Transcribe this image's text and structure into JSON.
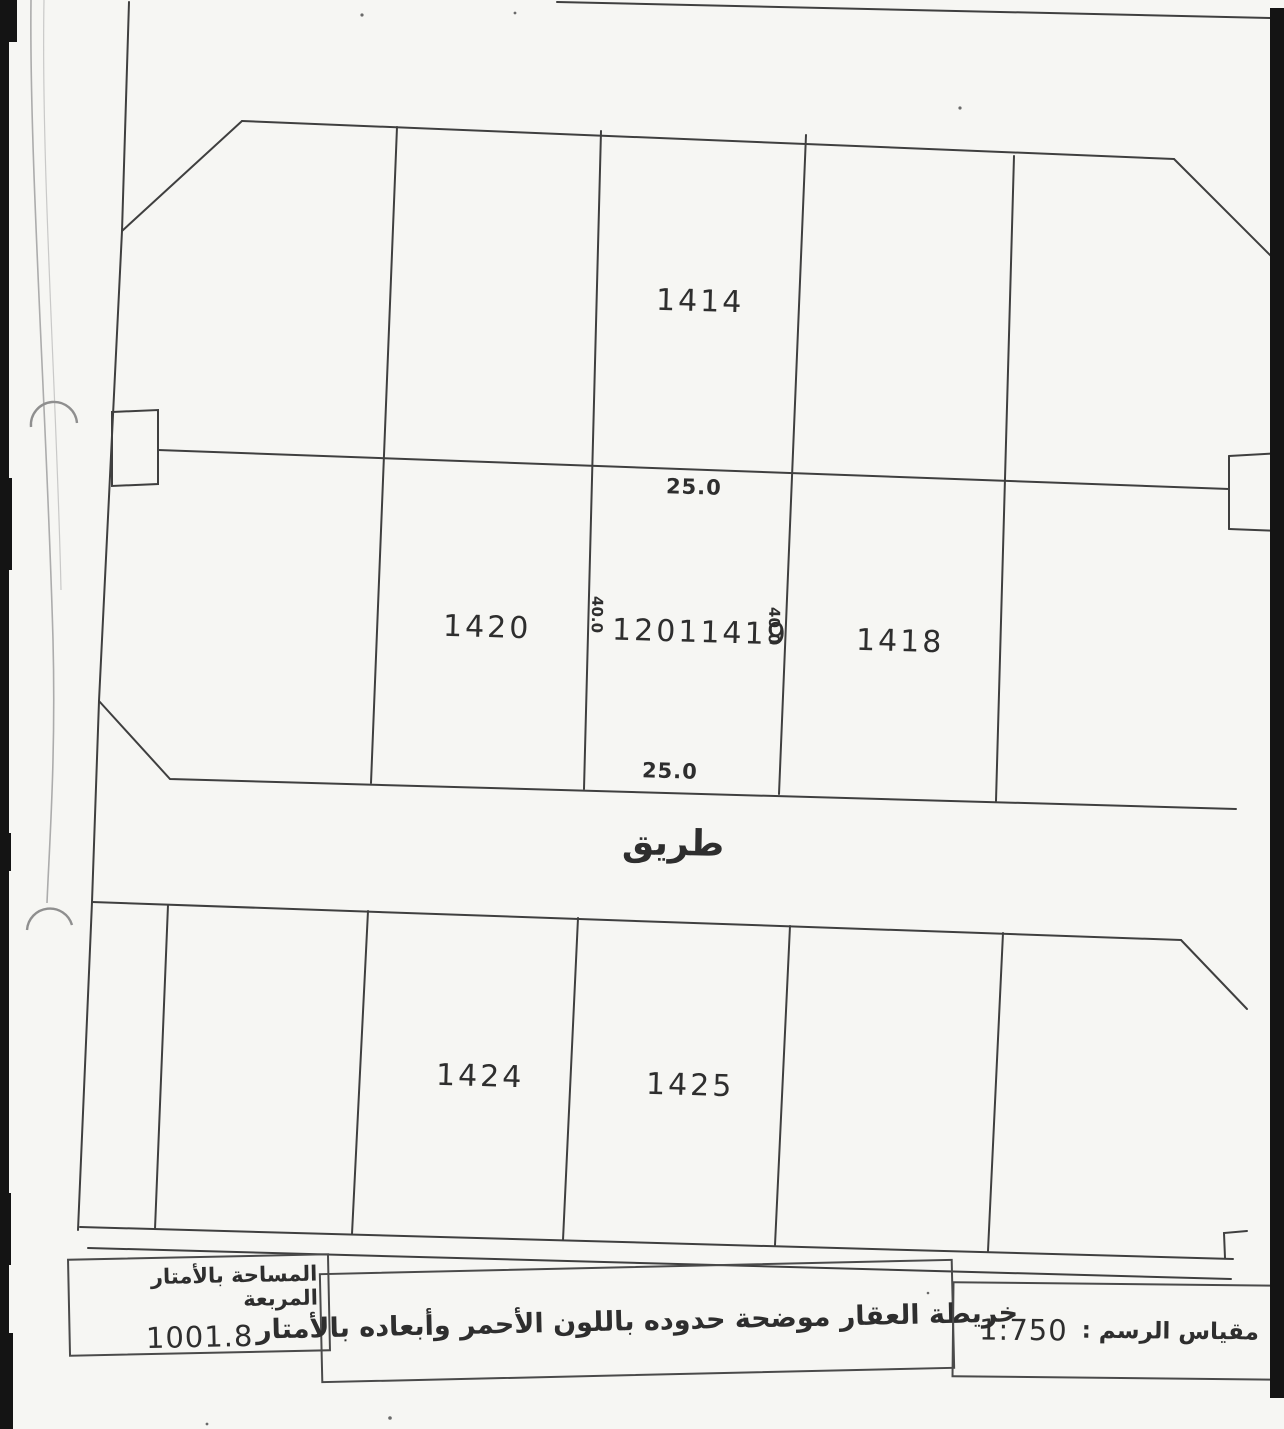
{
  "map": {
    "road_label": "طريق",
    "plots": {
      "p1414": "1414",
      "p1420": "1420",
      "p1419_prefix": "1201",
      "p1419": "1419",
      "p1418": "1418",
      "p1424": "1424",
      "p1425": "1425"
    },
    "dimensions": {
      "width_top": "25.0",
      "width_bottom": "25.0",
      "depth_left": "40.0",
      "depth_right": "40.0"
    }
  },
  "footer": {
    "area_label": "المساحة بالأمتار المربعة",
    "area_value": "1001.8",
    "note": "خريطة العقار موضحة حدوده باللون الأحمر وأبعاده بالأمتار",
    "scale_label": "مقياس الرسم :",
    "scale_value": "1:750"
  },
  "colors": {
    "paper": "#f6f6f3",
    "line": "#3f3f3f",
    "text": "#2e2e2e",
    "scan_edge": "#141414"
  }
}
